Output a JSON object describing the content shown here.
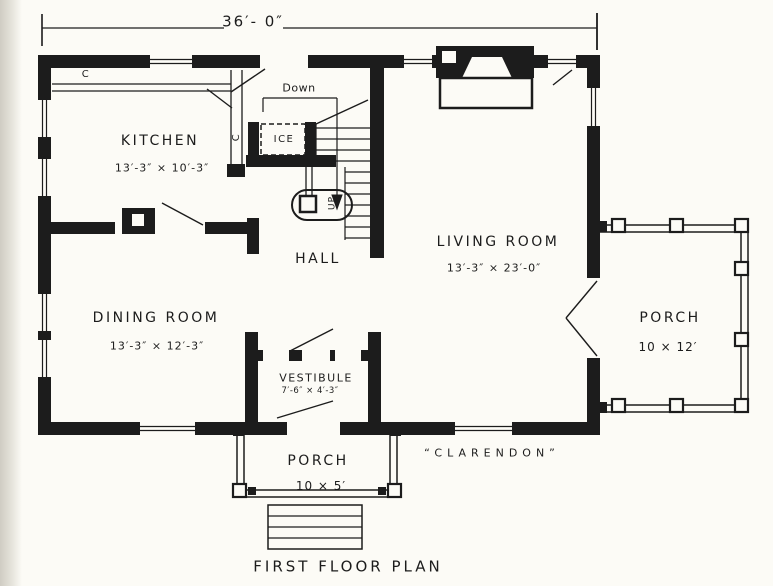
{
  "palette": {
    "paper": "#fcfbf6",
    "ink": "#1c1c1c",
    "page_edge": "#d6d4cc"
  },
  "dimension": {
    "overall_width": "36′- 0″"
  },
  "rooms": {
    "kitchen": {
      "label": "KITCHEN",
      "dims": "13′-3″ × 10′-3″"
    },
    "hall": {
      "label": "HALL"
    },
    "living_room": {
      "label": "LIVING ROOM",
      "dims": "13′-3″ × 23′-0″"
    },
    "dining_room": {
      "label": "DINING ROOM",
      "dims": "13′-3″ × 12′-3″"
    },
    "vestibule": {
      "label": "VESTIBULE",
      "dims": "7′-6″ × 4′-3″"
    },
    "front_porch": {
      "label": "PORCH",
      "dims": "10 × 5′"
    },
    "side_porch": {
      "label": "PORCH",
      "dims": "10 × 12′"
    }
  },
  "annotations": {
    "down": "Down",
    "ice": "ICE",
    "up": "UP",
    "kitchen_cupboard": "C",
    "hall_closet": "C"
  },
  "captions": {
    "house_name": "“CLARENDON”",
    "plan_title": "FIRST FLOOR PLAN"
  }
}
